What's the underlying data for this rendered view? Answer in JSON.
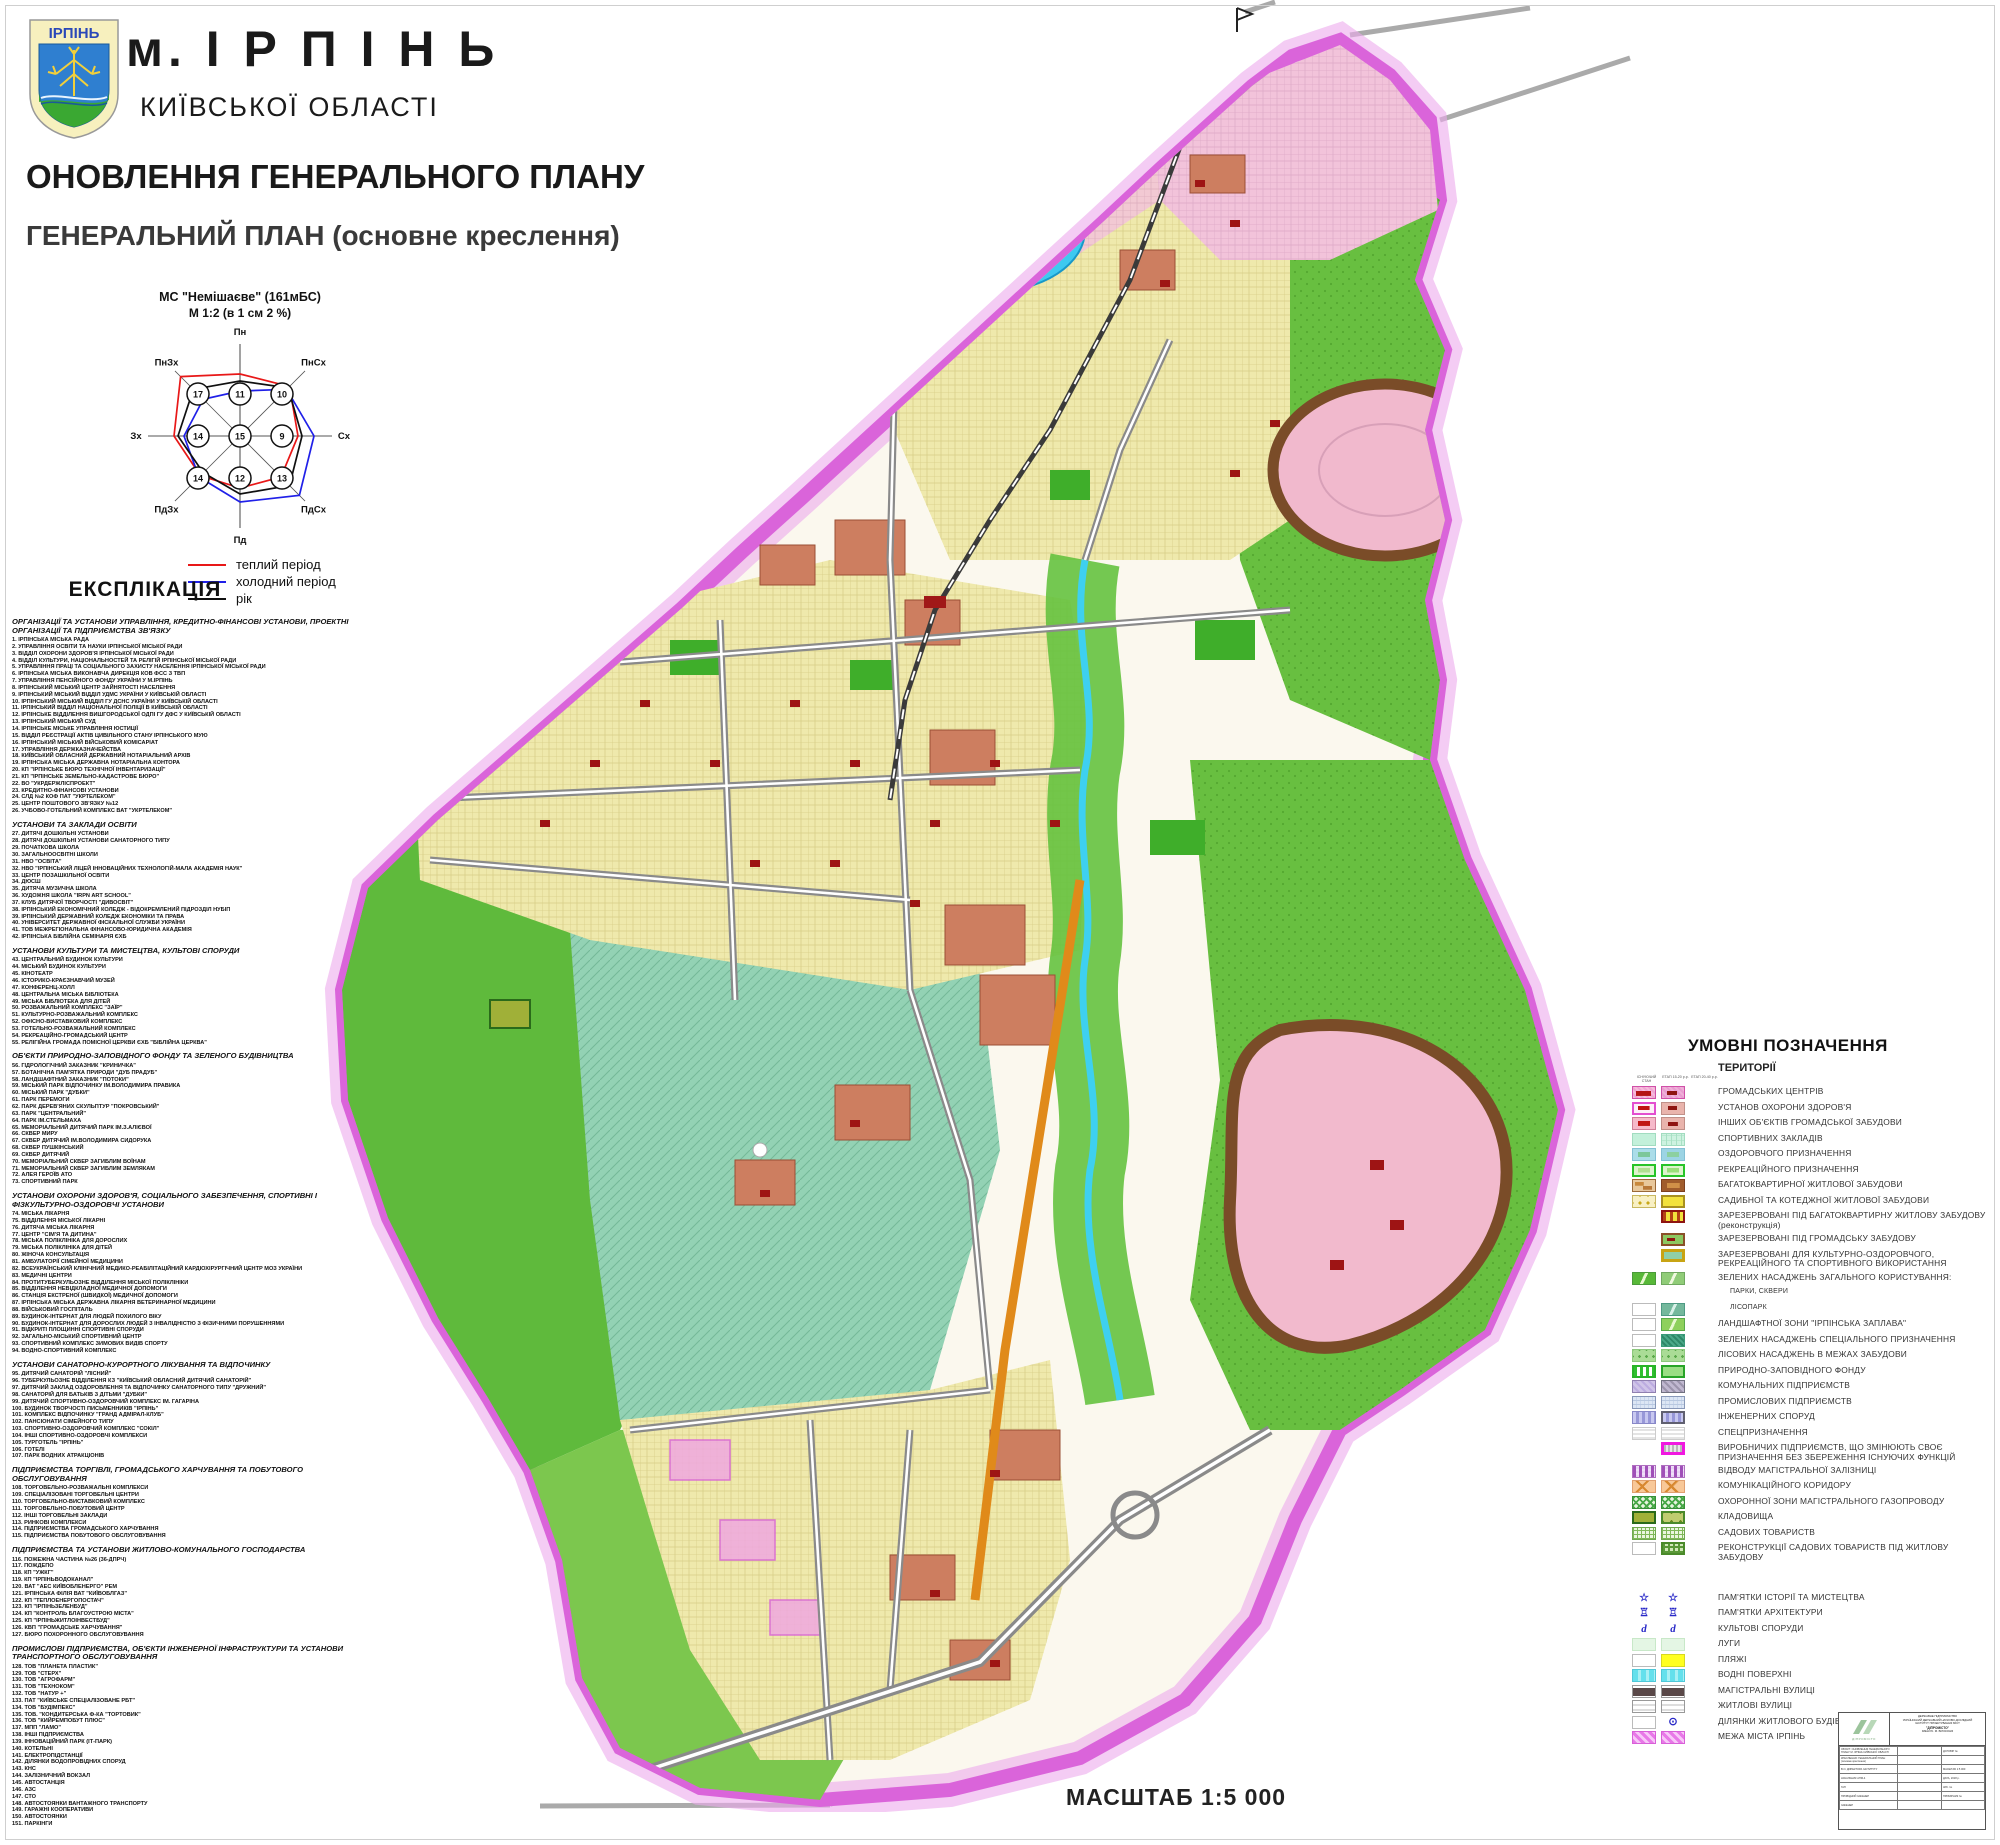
{
  "header": {
    "coat_text": "ІРПІНЬ",
    "city": "м. І Р П І Н Ь",
    "region": "КИЇВСЬКОЇ ОБЛАСТІ",
    "title1": "ОНОВЛЕННЯ ГЕНЕРАЛЬНОГО ПЛАНУ",
    "title2": "ГЕНЕРАЛЬНИЙ ПЛАН (основне креслення)"
  },
  "wind_rose": {
    "station": "МС \"Немішаєве\" (161мБС)",
    "scale": "М 1:2 (в 1 см 2 %)",
    "directions": [
      "Пн",
      "ПнСх",
      "Сх",
      "ПдСх",
      "Пд",
      "ПдЗх",
      "Зх",
      "ПнЗх"
    ],
    "grid_values": [
      [
        17,
        11,
        10
      ],
      [
        14,
        15,
        9
      ],
      [
        14,
        12,
        13
      ]
    ],
    "series": [
      {
        "name": "теплий період",
        "color": "#e81818"
      },
      {
        "name": "холодний період",
        "color": "#2020e8"
      },
      {
        "name": "рік",
        "color": "#101010"
      }
    ]
  },
  "explication": {
    "heading": "ЕКСПЛІКАЦІЯ",
    "sections": [
      {
        "title": "ОРГАНІЗАЦІЇ ТА УСТАНОВИ УПРАВЛІННЯ, КРЕДИТНО-ФІНАНСОВІ УСТАНОВИ, ПРОЕКТНІ ОРГАНІЗАЦІЇ ТА ПІДПРИЄМСТВА ЗВ'ЯЗКУ",
        "items": [
          "ІРПІНСЬКА МІСЬКА РАДА",
          "УПРАВЛІННЯ ОСВІТИ ТА НАУКИ ІРПІНСЬКОЇ МІСЬКОЇ РАДИ",
          "ВІДДІЛ ОХОРОНИ ЗДОРОВ'Я ІРПІНСЬКОЇ МІСЬКОЇ РАДИ",
          "ВІДДІЛ КУЛЬТУРИ, НАЦІОНАЛЬНОСТЕЙ ТА РЕЛІГІЙ ІРПІНСЬКОЇ МІСЬКОЇ РАДИ",
          "УПРАВЛІННЯ ПРАЦІ ТА СОЦІАЛЬНОГО ЗАХИСТУ НАСЕЛЕННЯ ІРПІНСЬКОЇ МІСЬКОЇ РАДИ",
          "ІРПІНСЬКА МІСЬКА ВИКОНАВЧА ДИРЕКЦІЯ КОВ ФСС З ТВП",
          "УПРАВЛІННЯ ПЕНСІЙНОГО ФОНДУ УКРАЇНИ У М.ІРПІНЬ",
          "ІРПІНСЬКИЙ МІСЬКИЙ ЦЕНТР ЗАЙНЯТОСТІ НАСЕЛЕННЯ",
          "ІРПІНСЬКИЙ МІСЬКИЙ ВІДДІЛ УДМС УКРАЇНИ У КИЇВСЬКІЙ ОБЛАСТІ",
          "ІРПІНСЬКИЙ МІСЬКИЙ ВІДДІЛ ГУ ДСНС УКРАЇНИ У КИЇВСЬКІЙ ОБЛАСТІ",
          "ІРПІНСЬКИЙ ВІДДІЛ НАЦІОНАЛЬНОЇ ПОЛІЦІЇ В КИЇВСЬКІЙ ОБЛАСТІ",
          "ІРПІНСЬКЕ ВІДДІЛЕННЯ ВИШГОРОДСЬКОЇ ОДПІ ГУ ДФС У КИЇВСЬКІЙ ОБЛАСТІ",
          "ІРПІНСЬКИЙ МІСЬКИЙ СУД",
          "ІРПІНСЬКЕ МІСЬКЕ УПРАВЛІННЯ ЮСТИЦІЇ",
          "ВІДДІЛ РЕЄСТРАЦІЇ АКТІВ ЦИВІЛЬНОГО СТАНУ ІРПІНСЬКОГО МУЮ",
          "ІРПІНСЬКИЙ МІСЬКИЙ ВІЙСЬКОВИЙ КОМІСАРІАТ",
          "УПРАВЛІННЯ ДЕРЖКАЗНАЧЕЙСТВА",
          "КИЇВСЬКИЙ ОБЛАСНИЙ ДЕРЖАВНИЙ НОТАРІАЛЬНИЙ АРХІВ",
          "ІРПІНСЬКА МІСЬКА ДЕРЖАВНА НОТАРІАЛЬНА КОНТОРА",
          "КП \"ІРПІНСЬКЕ БЮРО ТЕХНІЧНОЇ ІНВЕНТАРИЗАЦІЇ\"",
          "КП \"ІРПІНСЬКЕ ЗЕМЕЛЬНО-КАДАСТРОВЕ БЮРО\"",
          "ВО \"УКРДЕРЖЛІСПРОЕКТ\"",
          "КРЕДИТНО-ФІНАНСОВІ УСТАНОВИ",
          "СЛД №2 КОФ ПАТ \"УКРТЕЛЕКОМ\"",
          "ЦЕНТР ПОШТОВОГО ЗВ'ЯЗКУ №12",
          "УЧБОВО-ГОТЕЛЬНИЙ КОМПЛЕКС ВАТ \"УКРТЕЛЕКОМ\""
        ]
      },
      {
        "title": "УСТАНОВИ ТА ЗАКЛАДИ ОСВІТИ",
        "items": [
          "ДИТЯЧІ ДОШКІЛЬНІ УСТАНОВИ",
          "ДИТЯЧІ ДОШКІЛЬНІ УСТАНОВИ САНАТОРНОГО ТИПУ",
          "ПОЧАТКОВА ШКОЛА",
          "ЗАГАЛЬНООСВІТНІ ШКОЛИ",
          "НВО \"ОСВІТА\"",
          "НВО \"ІРПІНСЬКИЙ ЛІЦЕЙ ІННОВАЦІЙНИХ ТЕХНОЛОГІЙ-МАЛА АКАДЕМІЯ НАУК\"",
          "ЦЕНТР ПОЗАШКІЛЬНОЇ ОСВІТИ",
          "ДЮСШ",
          "ДИТЯЧА МУЗИЧНА ШКОЛА",
          "ХУДОЖНЯ ШКОЛА \"IRPN ART SCHOOL\"",
          "КЛУБ ДИТЯЧОЇ ТВОРЧОСТІ \"ДИВОСВІТ\"",
          "ІРПІНСЬКИЙ ЕКОНОМІЧНИЙ КОЛЕДЖ - ВІДОКРЕМЛЕНИЙ ПІДРОЗДІЛ НУБІП",
          "ІРПІНСЬКИЙ ДЕРЖАВНИЙ КОЛЕДЖ ЕКОНОМІКИ ТА ПРАВА",
          "УНІВЕРСИТЕТ ДЕРЖАВНОЇ ФІСКАЛЬНОЇ СЛУЖБИ УКРАЇНИ",
          "ТОВ МЕЖРЕГІОНАЛЬНА ФІНАНСОВО-ЮРИДИЧНА АКАДЕМІЯ",
          "ІРПІНСЬКА БІБЛІЙНА СЕМІНАРІЯ ЄХБ"
        ]
      },
      {
        "title": "УСТАНОВИ КУЛЬТУРИ ТА МИСТЕЦТВА, КУЛЬТОВІ СПОРУДИ",
        "items": [
          "ЦЕНТРАЛЬНИЙ БУДИНОК КУЛЬТУРИ",
          "МІСЬКИЙ БУДИНОК КУЛЬТУРИ",
          "КІНОТЕАТР",
          "ІСТОРИКО-КРАЄЗНАВЧИЙ МУЗЕЙ",
          "КОНФЕРЕНЦ-ХОЛЛ",
          "ЦЕНТРАЛЬНА МІСЬКА БІБЛІОТЕКА",
          "МІСЬКА БІБЛІОТЕКА ДЛЯ ДІТЕЙ",
          "РОЗВАЖАЛЬНИЙ КОМПЛЕКС \"ЗАЇР\"",
          "КУЛЬТУРНО-РОЗВАЖАЛЬНИЙ КОМПЛЕКС",
          "ОФІСНО-ВИСТАВКОВИЙ КОМПЛЕКС",
          "ГОТЕЛЬНО-РОЗВАЖАЛЬНИЙ КОМПЛЕКС",
          "РЕКРЕАЦІЙНО-ГРОМАДСЬКИЙ ЦЕНТР",
          "РЕЛІГІЙНА ГРОМАДА ПОМІСНОЇ ЦЕРКВИ ЄХБ \"БІБЛІЙНА ЦЕРКВА\""
        ]
      },
      {
        "title": "ОБ'ЄКТИ ПРИРОДНО-ЗАПОВІДНОГО ФОНДУ ТА ЗЕЛЕНОГО БУДІВНИЦТВА",
        "items": [
          "ГІДРОЛОГІЧНИЙ ЗАКАЗНИК \"КРИНИЧКА\"",
          "БОТАНІЧНА ПАМ'ЯТКА ПРИРОДИ \"ДУБ ПРАДУБ\"",
          "ЛАНДШАФТНИЙ ЗАКАЗНИК \"ПОТОКИ\"",
          "МІСЬКИЙ ПАРК ВІДПОЧИНКУ ІМ.ВОЛОДИМИРА ПРАВИКА",
          "МІСЬКИЙ ПАРК \"ДУБКИ\"",
          "ПАРК ПЕРЕМОГИ",
          "ПАРК ДЕРЕВ'ЯНИХ СКУЛЬПТУР \"ПОКРОВСЬКИЙ\"",
          "ПАРК \"ЦЕНТРАЛЬНИЙ\"",
          "ПАРК ІМ.СТЕЛЬМАХА",
          "МЕМОРІАЛЬНИЙ ДИТЯЧИЙ ПАРК ІМ.З.АЛІЄВОЇ",
          "СКВЕР МИРУ",
          "СКВЕР ДИТЯЧИЙ ІМ.ВОЛОДИМИРА СИДОРУКА",
          "СКВЕР ПУШКІНСЬКИЙ",
          "СКВЕР ДИТЯЧИЙ",
          "МЕМОРІАЛЬНИЙ СКВЕР ЗАГИБЛИМ ВОЇНАМ",
          "МЕМОРІАЛЬНИЙ СКВЕР ЗАГИБЛИМ ЗЕМЛЯКАМ",
          "АЛЕЯ ГЕРОЇВ АТО",
          "СПОРТИВНИЙ ПАРК"
        ]
      },
      {
        "title": "УСТАНОВИ ОХОРОНИ ЗДОРОВ'Я, СОЦІАЛЬНОГО ЗАБЕЗПЕЧЕННЯ, СПОРТИВНІ І ФІЗКУЛЬТУРНО-ОЗДОРОВЧІ УСТАНОВИ",
        "items": [
          "МІСЬКА ЛІКАРНЯ",
          "ВІДДІЛЕННЯ МІСЬКОЇ ЛІКАРНІ",
          "ДИТЯЧА МІСЬКА ЛІКАРНЯ",
          "ЦЕНТР \"СІМ'Я ТА ДИТИНА\"",
          "МІСЬКА ПОЛІКЛІНІКА ДЛЯ ДОРОСЛИХ",
          "МІСЬКА ПОЛІКЛІНІКА ДЛЯ ДІТЕЙ",
          "ЖІНОЧА КОНСУЛЬТАЦІЯ",
          "АМБУЛАТОРІЇ СІМЕЙНОЇ МЕДИЦИНИ",
          "ВСЕУКРАЇНСЬКИЙ КЛІНІЧНИЙ МЕДИКО-РЕАБІЛІТАЦІЙНИЙ КАРДІОХІРУРГІЧНИЙ ЦЕНТР МОЗ УКРАЇНИ",
          "МЕДИЧНІ ЦЕНТРИ",
          "ПРОТИТУБЕРКУЛЬОЗНЕ ВІДДІЛЕННЯ МІСЬКОЇ ПОЛІКЛІНІКИ",
          "ВІДДІЛЕННЯ НЕВІДКЛАДНОЇ МЕДИЧНОЇ ДОПОМОГИ",
          "СТАНЦІЯ ЕКСТРЕНОЇ (ШВИДКОЇ) МЕДИЧНОЇ ДОПОМОГИ",
          "ІРПІНСЬКА МІСЬКА ДЕРЖАВНА ЛІКАРНЯ ВЕТЕРИНАРНОЇ МЕДИЦИНИ",
          "ВІЙСЬКОВИЙ ГОСПІТАЛЬ",
          "БУДИНОК-ІНТЕРНАТ ДЛЯ ЛЮДЕЙ ПОХИЛОГО ВІКУ",
          "БУДИНОК-ІНТЕРНАТ ДЛЯ ДОРОСЛИХ ЛЮДЕЙ З ІНВАЛІДНІСТЮ З ФІЗИЧНИМИ ПОРУШЕННЯМИ",
          "ВІДКРИТІ ПЛОЩИННІ СПОРТИВНІ СПОРУДИ",
          "ЗАГАЛЬНО-МІСЬКИЙ СПОРТИВНИЙ ЦЕНТР",
          "СПОРТИВНИЙ КОМПЛЕКС ЗИМОВИХ ВИДІВ СПОРТУ",
          "ВОДНО-СПОРТИВНИЙ КОМПЛЕКС"
        ]
      },
      {
        "title": "УСТАНОВИ САНАТОРНО-КУРОРТНОГО ЛІКУВАННЯ ТА ВІДПОЧИНКУ",
        "items": [
          "ДИТЯЧИЙ САНАТОРІЙ \"ЛІСНИЙ\"",
          "ТУБЕРКУЛЬОЗНЕ ВІДДІЛЕННЯ КЗ \"КИЇВСЬКИЙ ОБЛАСНИЙ ДИТЯЧИЙ САНАТОРІЙ\"",
          "ДИТЯЧИЙ ЗАКЛАД ОЗДОРОВЛЕННЯ ТА ВІДПОЧИНКУ САНАТОРНОГО ТИПУ \"ДРУЖНИЙ\"",
          "САНАТОРІЙ ДЛЯ БАТЬКІВ З ДІТЬМИ \"ДУБКИ\"",
          "ДИТЯЧИЙ СПОРТИВНО-ОЗДОРОВЧИЙ КОМПЛЕКС ІМ. ГАГАРІНА",
          "БУДИНОК ТВОРЧОСТІ ПИСЬМЕННИКІВ \"ІРПІНЬ\"",
          "КОМПЛЕКС ВІДПОЧИНКУ \"ГРАНД АДМІРАЛ-КЛУБ\"",
          "ПАНСІОНАТИ СІМЕЙНОГО ТИПУ",
          "СПОРТИВНО-ОЗДОРОВЧИЙ КОМПЛЕКС \"СОКІЛ\"",
          "ІНШІ СПОРТИВНО-ОЗДОРОВЧІ КОМПЛЕКСИ",
          "ТУРГОТЕЛЬ \"ІРПІНЬ\"",
          "ГОТЕЛІ",
          "ПАРК ВОДНИХ АТРАКЦІОНІВ"
        ]
      },
      {
        "title": "ПІДПРИЄМСТВА ТОРГІВЛІ, ГРОМАДСЬКОГО ХАРЧУВАННЯ ТА ПОБУТОВОГО ОБСЛУГОВУВАННЯ",
        "items": [
          "ТОРГОВЕЛЬНО-РОЗВАЖАЛЬНІ КОМПЛЕКСИ",
          "СПЕЦІАЛІЗОВАНІ ТОРГОВЕЛЬНІ ЦЕНТРИ",
          "ТОРГОВЕЛЬНО-ВИСТАВКОВИЙ КОМПЛЕКС",
          "ТОРГОВЕЛЬНО-ПОБУТОВИЙ ЦЕНТР",
          "ІНШІ ТОРГОВЕЛЬНІ ЗАКЛАДИ",
          "РИНКОВІ КОМПЛЕКСИ",
          "ПІДПРИЄМСТВА ГРОМАДСЬКОГО ХАРЧУВАННЯ",
          "ПІДПРИЄМСТВА ПОБУТОВОГО ОБСЛУГОВУВАННЯ"
        ]
      },
      {
        "title": "ПІДПРИЄМСТВА ТА УСТАНОВИ ЖИТЛОВО-КОМУНАЛЬНОГО ГОСПОДАРСТВА",
        "items": [
          "ПОЖЕЖНА ЧАСТИНА №26 (36-ДПРЧ)",
          "ПОЖДЕПО",
          "КП \"УЖКГ\"",
          "КП \"ІРПІНЬВОДОКАНАЛ\"",
          "ВАТ \"АЕС КИЇВОБЛЕНЕРГО\" РЕМ",
          "ІРПІНСЬКА ФІЛІЯ ВАТ \"КИЇВОБЛГАЗ\"",
          "КП \"ТЕПЛОЕНЕРГОПОСТАЧ\"",
          "КП \"ІРПІНЬЗЕЛЕНБУД\"",
          "КП \"КОНТРОЛЬ БЛАГОУСТРОЮ МІСТА\"",
          "КП \"ІРПІНЬЖИТЛОІНВЕСТБУД\"",
          "КВП \"ГРОМАДСЬКЕ ХАРЧУВАННЯ\"",
          "БЮРО ПОХОРОННОГО ОБСЛУГОВУВАННЯ"
        ]
      },
      {
        "title": "ПРОМИСЛОВІ ПІДПРИЄМСТВА, ОБ'ЄКТИ ІНЖЕНЕРНОЇ ІНФРАСТРУКТУРИ ТА УСТАНОВИ ТРАНСПОРТНОГО ОБСЛУГОВУВАННЯ",
        "items": [
          "ТОВ \"ПЛАНЕТА ПЛАСТИК\"",
          "ТОВ \"СТЕРХ\"",
          "ТОВ \"АГРОФАРМ\"",
          "ТОВ \"ТЕХНОКОМ\"",
          "ТОВ \"НАТУР +\"",
          "ПАТ \"КИЇВСЬКЕ СПЕЦІАЛІЗОВАНЕ РБТ\"",
          "ТОВ \"БУДІМПЕКС\"",
          "ТОВ. \"КОНДИТЕРСЬКА Ф-КА \"ТОРТОВИК\"",
          "ТОВ \"КИЙРЕМПОБУТ ПЛЮС\"",
          "МПП \"ЛАМО\"",
          "ІНШІ ПІДПРИЄМСТВА",
          "ІННОВАЦІЙНИЙ ПАРК (ІТ-ПАРК)",
          "КОТЕЛЬНІ",
          "ЕЛЕКТРОПІДСТАНЦІЇ",
          "ДІЛЯНКИ ВОДОПРОВІДНИХ СПОРУД",
          "КНС",
          "ЗАЛІЗНИЧНИЙ ВОКЗАЛ",
          "АВТОСТАНЦІЯ",
          "АЗС",
          "СТО",
          "АВТОСТОЯНКИ ВАНТАЖНОГО ТРАНСПОРТУ",
          "ГАРАЖНІ КООПЕРАТИВИ",
          "АВТОСТОЯНКИ",
          "ПАРКІНГИ"
        ]
      }
    ]
  },
  "legend": {
    "title": "УМОВНІ ПОЗНАЧЕННЯ",
    "group_title": "ТЕРИТОРІЇ",
    "col_headers": [
      "ІСНУЮЧИЙ СТАН",
      "ЕТАП 15-20 р.р.",
      "ЕТАП 20-40 р.р."
    ],
    "rows": [
      {
        "l": "ГРОМАДСЬКИХ ЦЕНТРІВ",
        "s1": "gc1",
        "s2": "gc2"
      },
      {
        "l": "УСТАНОВ ОХОРОНИ ЗДОРОВ'Я",
        "s1": "hl1",
        "s2": "hl2"
      },
      {
        "l": "ІНШИХ ОБ'ЄКТІВ ГРОМАДСЬКОЇ ЗАБУДОВИ",
        "s1": "pb1",
        "s2": "pb2"
      },
      {
        "l": "СПОРТИВНИХ ЗАКЛАДІВ",
        "s1": "sp1",
        "s2": "sp2"
      },
      {
        "l": "ОЗДОРОВЧОГО ПРИЗНАЧЕННЯ",
        "s1": "oz1",
        "s2": "oz2"
      },
      {
        "l": "РЕКРЕАЦІЙНОГО ПРИЗНАЧЕННЯ",
        "s1": "rk1",
        "s2": "rk2"
      },
      {
        "l": "БАГАТОКВАРТИРНОЇ ЖИТЛОВОЇ ЗАБУДОВИ",
        "s1": "bg1",
        "s2": "bg2"
      },
      {
        "l": "САДИБНОЇ ТА КОТЕДЖНОЇ ЖИТЛОВОЇ ЗАБУДОВИ",
        "s1": "sd1",
        "s2": "sd2"
      },
      {
        "l": "ЗАРЕЗЕРВОВАНІ ПІД БАГАТОКВАРТИРНУ ЖИТЛОВУ ЗАБУДОВУ (реконструкція)",
        "s1": "blank",
        "s2": "rzb"
      },
      {
        "l": "ЗАРЕЗЕРВОВАНІ ПІД ГРОМАДСЬКУ ЗАБУДОВУ",
        "s1": "blank",
        "s2": "rzg"
      },
      {
        "l": "ЗАРЕЗЕРВОВАНІ ДЛЯ КУЛЬТУРНО-ОЗДОРОВЧОГО, РЕКРЕАЦІЙНОГО ТА СПОРТИВНОГО ВИКОРИСТАННЯ",
        "s1": "blank",
        "s2": "rzk"
      },
      {
        "l": "ЗЕЛЕНИХ НАСАДЖЕНЬ ЗАГАЛЬНОГО КОРИСТУВАННЯ:",
        "s1": "pk1",
        "s2": "pk2"
      },
      {
        "l": "ПАРКИ, СКВЕРИ",
        "small": true
      },
      {
        "l": "ЛІСОПАРК",
        "s1": "wh",
        "s2": "lsp",
        "small": true
      },
      {
        "l": "ЛАНДШАФТНОЇ ЗОНИ \"ІРПІНСЬКА ЗАПЛАВА\"",
        "s1": "wh",
        "s2": "zpl"
      },
      {
        "l": "ЗЕЛЕНИХ НАСАДЖЕНЬ СПЕЦІАЛЬНОГО ПРИЗНАЧЕННЯ",
        "s1": "wh",
        "s2": "znsp"
      },
      {
        "l": "ЛІСОВИХ НАСАДЖЕНЬ В МЕЖАХ ЗАБУДОВИ",
        "s1": "lis",
        "s2": "lis"
      },
      {
        "l": "ПРИРОДНО-ЗАПОВІДНОГО ФОНДУ",
        "s1": "pzf1",
        "s2": "pzf2"
      },
      {
        "l": "КОМУНАЛЬНИХ ПІДПРИЄМСТВ",
        "s1": "km1",
        "s2": "km2"
      },
      {
        "l": "ПРОМИСЛОВИХ ПІДПРИЄМСТВ",
        "s1": "pr1",
        "s2": "pr1"
      },
      {
        "l": "ІНЖЕНЕРНИХ СПОРУД",
        "s1": "in1",
        "s2": "in2"
      },
      {
        "l": "СПЕЦПРИЗНАЧЕННЯ",
        "s1": "spc",
        "s2": "spc"
      },
      {
        "l": "ВИРОБНИЧИХ ПІДПРИЄМСТВ, ЩО ЗМІНЮЮТЬ СВОЄ ПРИЗНАЧЕННЯ БЕЗ ЗБЕРЕЖЕННЯ ІСНУЮЧИХ ФУНКЦІЙ",
        "s1": "blank",
        "s2": "vrb"
      },
      {
        "l": "ВІДВОДУ МАГІСТРАЛЬНОЇ ЗАЛІЗНИЦІ",
        "s1": "zlz",
        "s2": "zlz"
      },
      {
        "l": "КОМУНІКАЦІЙНОГО КОРИДОРУ",
        "s1": "krd",
        "s2": "krd"
      },
      {
        "l": "ОХОРОННОЇ ЗОНИ МАГІСТРАЛЬНОГО ГАЗОПРОВОДУ",
        "s1": "gaz",
        "s2": "gaz"
      },
      {
        "l": "КЛАДОВИЩА",
        "s1": "kl1",
        "s2": "kl2"
      },
      {
        "l": "САДОВИХ ТОВАРИСТВ",
        "s1": "sad",
        "s2": "sad"
      },
      {
        "l": "РЕКОНСТРУКЦІЇ САДОВИХ ТОВАРИСТВ ПІД ЖИТЛОВУ ЗАБУДОВУ",
        "s1": "wh",
        "s2": "sdr"
      },
      {
        "gap": true
      },
      {
        "l": "ПАМ'ЯТКИ ІСТОРІЇ ТА МИСТЕЦТВА",
        "sym": "star"
      },
      {
        "l": "ПАМ'ЯТКИ АРХІТЕКТУРИ",
        "sym": "arch"
      },
      {
        "l": "КУЛЬТОВІ СПОРУДИ",
        "sym": "cult"
      },
      {
        "l": "ЛУГИ",
        "s1": "lug",
        "s2": "lug"
      },
      {
        "l": "ПЛЯЖІ",
        "s1": "wh",
        "s2": "bch"
      },
      {
        "l": "ВОДНІ ПОВЕРХНІ",
        "s1": "wtr",
        "s2": "wtr"
      },
      {
        "l": "МАГІСТРАЛЬНІ ВУЛИЦІ",
        "s1": "mgs",
        "s2": "mgs"
      },
      {
        "l": "ЖИТЛОВІ ВУЛИЦІ",
        "s1": "zhv",
        "s2": "zhv"
      },
      {
        "l": "ДІЛЯНКИ ЖИТЛОВОГО БУДІВНИЦТВА",
        "s1": "wh",
        "sym2": "circle"
      },
      {
        "l": "МЕЖА МІСТА ІРПІНЬ",
        "s1": "mezh",
        "s2": "mezh"
      }
    ],
    "symbols": {
      "star": "☆",
      "arch": "♖",
      "cult": "d",
      "circle": "⊙"
    }
  },
  "scale_label": "МАСШТАБ 1:5 000",
  "stamp": {
    "logo_text": "ДІПРОМІСТО",
    "org_lines": [
      "ДЕРЖАВНЕ ПІДПРИЄМСТВО",
      "УКРАЇНСЬКИЙ ДЕРЖАВНИЙ НАУКОВО-ДОСЛІДНИЙ",
      "ІНСТИТУТ ПРОЕКТУВАННЯ МІСТ"
    ],
    "org_name": "\"ДІПРОМІСТО\"",
    "org_sub": "ІМЕНІ Ю. М. БІЛОКОНЯ",
    "rows": [
      [
        "ОБ'ЄКТ: ОНОВЛЕННЯ ГЕНЕРАЛЬНОГО ПЛАНУ М. ІРПІНЬ КИЇВСЬКОЇ ОБЛАСТІ",
        "",
        "ДОГОВІР №"
      ],
      [
        "КРЕСЛЕННЯ: ГЕНЕРАЛЬНИЙ ПЛАН (основне креслення)",
        "",
        ""
      ],
      [
        "В.О. ДИРЕКТОРА ІНСТИТУТУ",
        "",
        "МАСШТАБ 1:5 000"
      ],
      [
        "НАЧАЛЬНИК АПМ-4",
        "",
        "ДАТА, 2018 р."
      ],
      [
        "ГАП",
        "",
        "АРК. №"
      ],
      [
        "ПРОВІДНИЙ ІНЖЕНЕР",
        "",
        "ПРИМІРНИК №"
      ],
      [
        "ІНЖЕНЕР",
        "",
        ""
      ]
    ]
  },
  "colors": {
    "boundary": "#da64da",
    "boundary_glow": "#ecaaec",
    "water": "#3ec9f0",
    "forest": "#68bf40",
    "residential_yellow": "#efe9ac",
    "public_salmon": "#cd7e60",
    "building_red": "#9e1414",
    "pipeline_orange": "#e08a1a",
    "track_brown": "#7a4c28",
    "pink_zone": "#f2c3da",
    "teal_field": "#93d2b4"
  }
}
